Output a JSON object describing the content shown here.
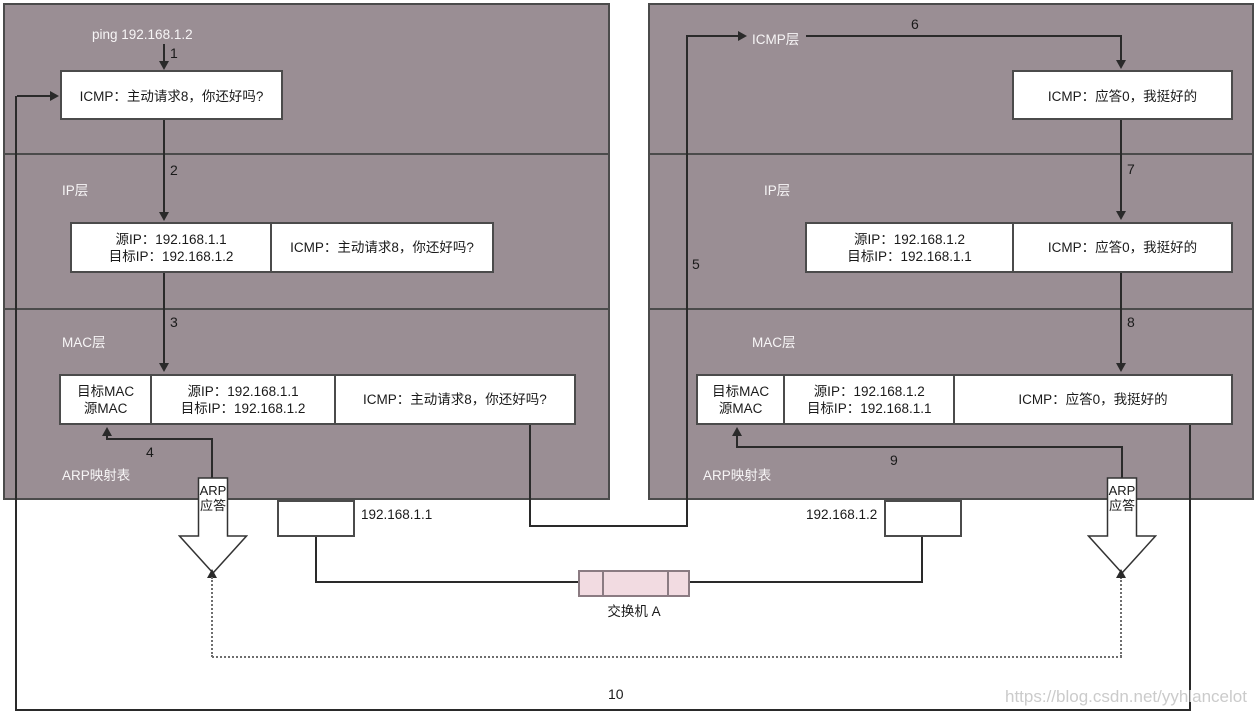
{
  "colors": {
    "panel_fill": "#9A8E94",
    "panel_border": "#4B4B4B",
    "flow_line": "#2A2A2A",
    "switch_fill": "#F2DBE1",
    "switch_border": "#8B7B82",
    "watermark_text": "#CBCBCB"
  },
  "left_host": {
    "ping_command": "ping 192.168.1.2",
    "icmp_box": "ICMP：主动请求8，你还好吗?",
    "ip_layer_label": "IP层",
    "ip_frame": {
      "ip_header": "源IP：192.168.1.1\n目标IP：192.168.1.2",
      "payload": "ICMP：主动请求8，你还好吗?"
    },
    "mac_layer_label": "MAC层",
    "mac_frame": {
      "mac_header": "目标MAC\n源MAC",
      "ip_header": "源IP：192.168.1.1\n目标IP：192.168.1.2",
      "payload": "ICMP：主动请求8，你还好吗?"
    },
    "arp_table_label": "ARP映射表",
    "arp_reply_label": "ARP\n应答",
    "nic_ip": "192.168.1.1"
  },
  "right_host": {
    "icmp_layer_label": "ICMP层",
    "icmp_box": "ICMP：应答0，我挺好的",
    "ip_layer_label": "IP层",
    "ip_frame": {
      "ip_header": "源IP：192.168.1.2\n目标IP：192.168.1.1",
      "payload": "ICMP：应答0，我挺好的"
    },
    "mac_layer_label": "MAC层",
    "mac_frame": {
      "mac_header": "目标MAC\n源MAC",
      "ip_header": "源IP：192.168.1.2\n目标IP：192.168.1.1",
      "payload": "ICMP：应答0，我挺好的"
    },
    "arp_table_label": "ARP映射表",
    "arp_reply_label": "ARP\n应答",
    "nic_ip": "192.168.1.2"
  },
  "network": {
    "switch_label": "交换机 A"
  },
  "steps": {
    "s1": "1",
    "s2": "2",
    "s3": "3",
    "s4": "4",
    "s5": "5",
    "s6": "6",
    "s7": "7",
    "s8": "8",
    "s9": "9",
    "s10": "10"
  },
  "watermark": "https://blog.csdn.net/yyhlancelot"
}
